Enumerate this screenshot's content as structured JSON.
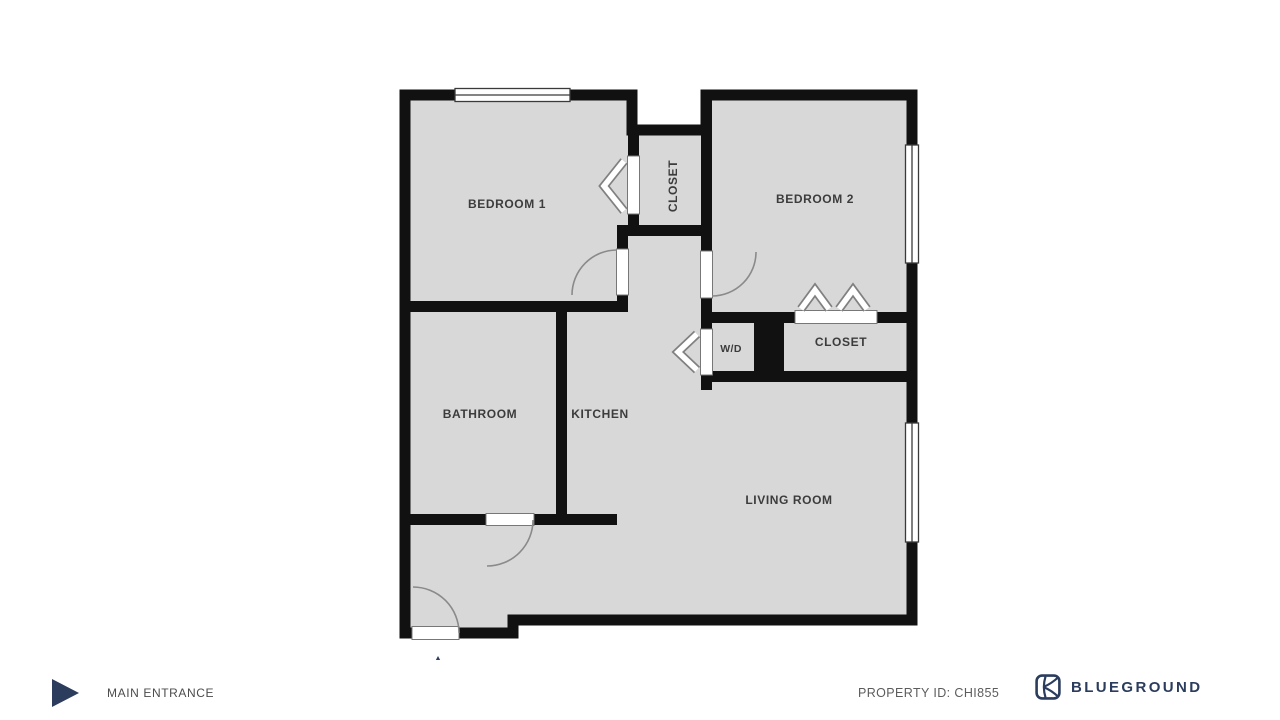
{
  "colors": {
    "wall": "#111111",
    "floor": "#d8d8d8",
    "brand_navy": "#2b3c5d",
    "label_gray": "#3c3c3c"
  },
  "rooms": {
    "bedroom1": "BEDROOM 1",
    "closet_top": "CLOSET",
    "bedroom2": "BEDROOM 2",
    "bathroom": "BATHROOM",
    "kitchen": "KITCHEN",
    "wd": "W/D",
    "closet2": "CLOSET",
    "living": "LIVING ROOM"
  },
  "footer": {
    "entrance_label": "MAIN ENTRANCE",
    "property_id": "PROPERTY ID: CHI855",
    "brand": "BLUEGROUND"
  }
}
